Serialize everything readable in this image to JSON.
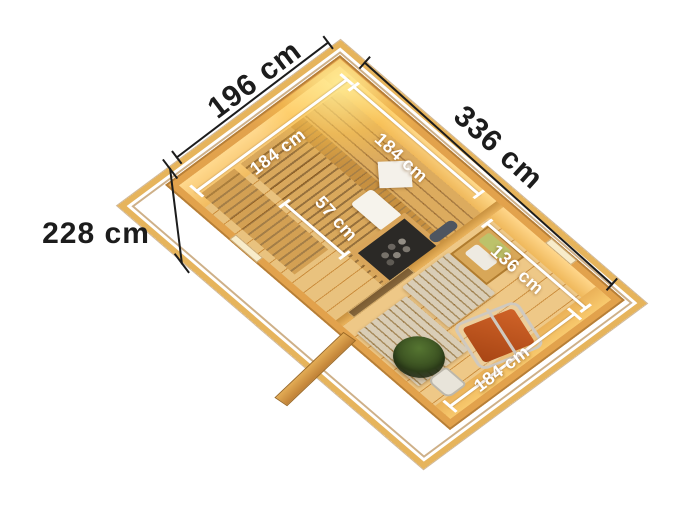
{
  "meta": {
    "title": "Sauna cabin 3D top view with dimensions",
    "background": "#ffffff"
  },
  "dims": {
    "outer_depth": "196 cm",
    "outer_length": "336 cm",
    "outer_height": "228 cm",
    "sauna_side_a": "184 cm",
    "sauna_side_b": "184 cm",
    "bench_depth": "57 cm",
    "anteroom_width": "136 cm",
    "anteroom_depth": "184 cm"
  },
  "colors": {
    "dimension_line": "#1c1c1c",
    "dimension_text": "#1c1c1c",
    "inner_dimension_text": "#ffffff",
    "wood_wall": "#e2a24c",
    "wood_wall_lit": "#ffd98e",
    "eaves_beam": "#e6b45c",
    "sauna_floor": "#e9c27e",
    "bench_wood": "#d9a85c",
    "anteroom_floor": "#eec887",
    "duckboard": "#d9cdb6",
    "stove_body": "#2b2926",
    "stove_stones": "#8a857c",
    "deck_chair": "#c2571f",
    "plant": "#35491e",
    "lamp_glow": "#ffe296",
    "towel_green": "#bcc26a",
    "towel_white": "#f4f1ea"
  },
  "objects": [
    "roof-eaves-frame",
    "sauna-room",
    "anteroom",
    "upper-bench",
    "backrest-slats",
    "middle-bench",
    "lower-bench",
    "headrest",
    "towel",
    "sauna-stove",
    "corner-lamp",
    "partition-wall",
    "glass-door",
    "duckboard-mats",
    "towel-shelf",
    "deck-chair",
    "potted-plant",
    "bucket",
    "open-entrance-door",
    "window"
  ]
}
